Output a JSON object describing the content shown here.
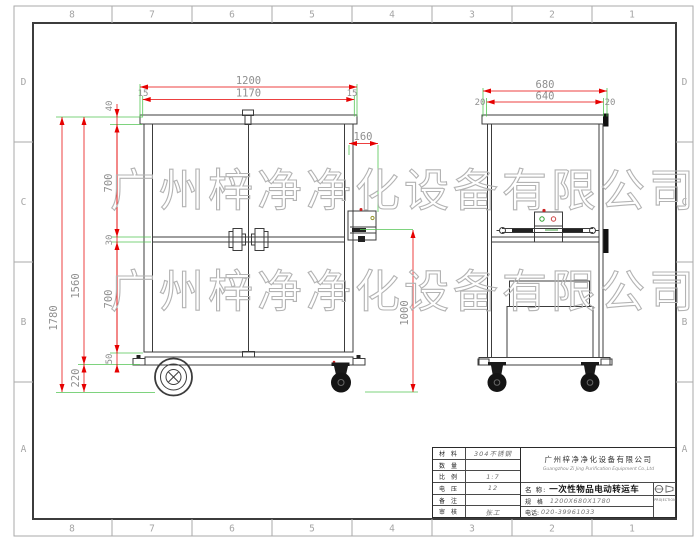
{
  "sheet": {
    "zone_cols": [
      "8",
      "7",
      "6",
      "5",
      "4",
      "3",
      "2",
      "1"
    ],
    "zone_rows": [
      "D",
      "C",
      "B",
      "A"
    ]
  },
  "watermark": {
    "text": "广州梓净净化设备有限公司"
  },
  "dimensions": {
    "front": {
      "width": "1200",
      "inner_width": "1170",
      "overhang_left": "15",
      "overhang_right": "15",
      "panel_thickness": "40",
      "upper_section": "700",
      "rail": "30",
      "lower_section": "700",
      "base": "50",
      "ground_clearance": "220",
      "overall_height": "1780",
      "body_height": "1560",
      "handle_offset": "160"
    },
    "side": {
      "depth": "680",
      "inner_depth": "640",
      "overhang_left": "20",
      "overhang_right": "20",
      "handle_height": "1000"
    }
  },
  "title_block": {
    "rows": [
      {
        "label": "材 料",
        "value": "304不锈钢"
      },
      {
        "label": "数 量",
        "value": ""
      },
      {
        "label": "比 例",
        "value": "1:7"
      },
      {
        "label": "电 压",
        "value": "12"
      },
      {
        "label": "备 注",
        "value": ""
      },
      {
        "label": "审 核",
        "value": "张工"
      }
    ],
    "company_cn": "广州梓净净化设备有限公司",
    "company_en": "Guangzhou Zi Jing Purification Equipment Co.,Ltd",
    "name_label": "名  称:",
    "name_value": "一次性物品电动转运车",
    "spec_label": "规  格",
    "spec_value": "1200X680X1780",
    "phone_label": "电话:",
    "phone_value": "020-39961033",
    "projection_label": "PROJECTION"
  },
  "colors": {
    "dimension_line": "#e60000",
    "extension_line": "#53c553",
    "drawing_line": "#3c3c3c",
    "watermark": "#b3b3b3"
  }
}
